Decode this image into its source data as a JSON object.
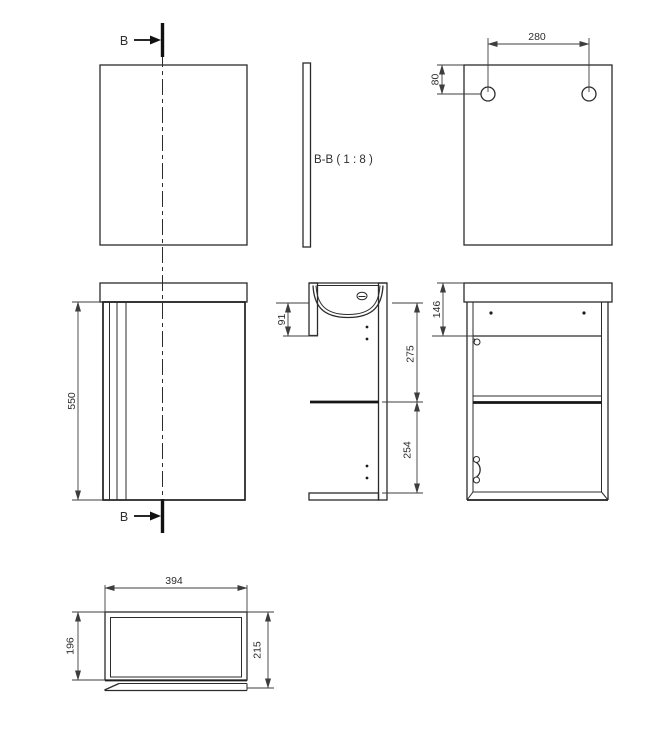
{
  "drawing": {
    "section_marker": "B",
    "section_view_label": "B-B ( 1 : 8 )",
    "dimensions": {
      "hole_spacing": "280",
      "hole_top_offset": "80",
      "cabinet_height": "550",
      "basin_front_depth": "91",
      "upper_compartment": "275",
      "lower_compartment": "254",
      "back_top_rail": "146",
      "cabinet_width": "394",
      "body_depth": "196",
      "overall_depth": "215"
    },
    "colors": {
      "line": "#2b2b2b",
      "background": "#ffffff"
    }
  }
}
